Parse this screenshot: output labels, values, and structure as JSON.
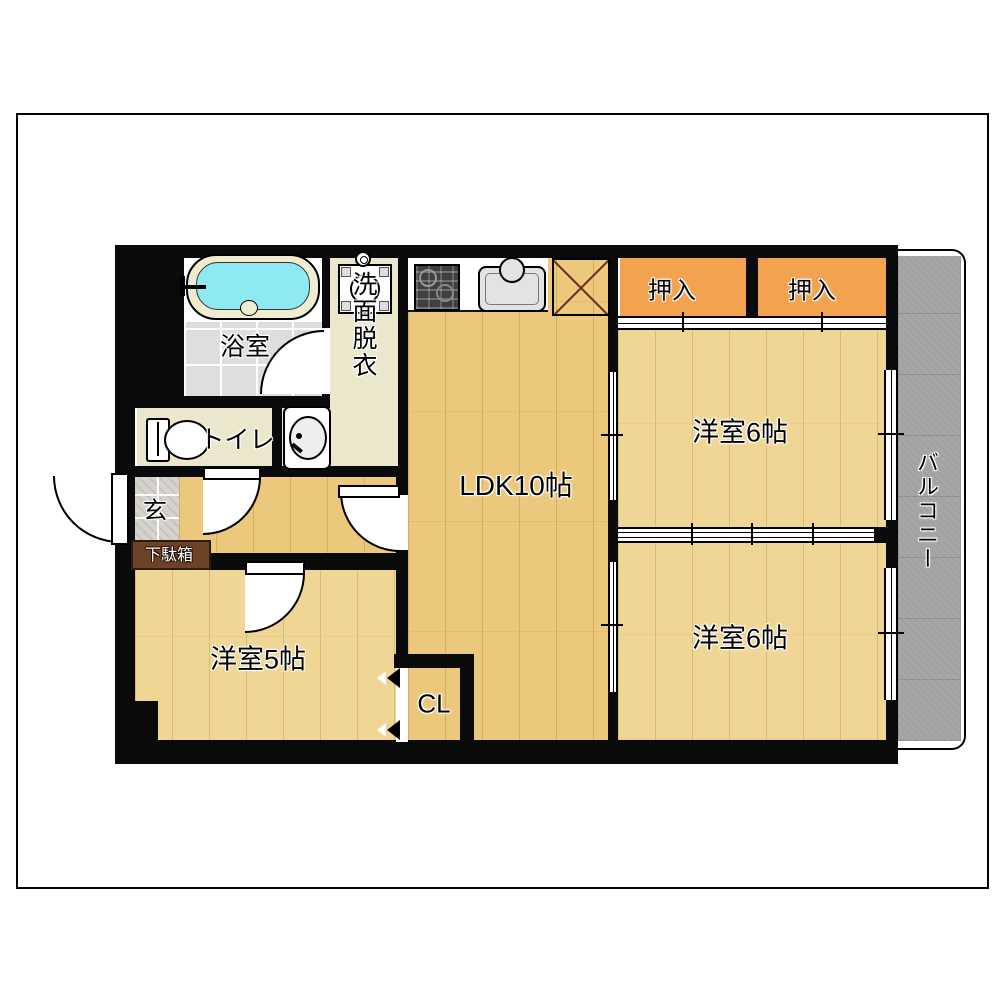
{
  "plan": {
    "labels": {
      "bathroom": "浴室",
      "washroom": "洗面脱衣",
      "toilet": "トイレ",
      "entrance": "玄",
      "shoe_cabinet": "下駄箱",
      "ldk": "LDK10帖",
      "oshiire_left": "押入",
      "oshiire_right": "押入",
      "western_room_6_top": "洋室6帖",
      "western_room_6_bottom": "洋室6帖",
      "western_room_5": "洋室5帖",
      "closet": "CL",
      "balcony": "バルコニー"
    },
    "colors": {
      "wall": "#0a0a0a",
      "wood-hall": "#ecc87c",
      "wood-room": "#f0d694",
      "closet": "#f3a24d",
      "beige": "#eae7cc",
      "bath-tile": "#dedede",
      "genkan-tile": "#d6d3cf",
      "balcony": "#a2a2a4",
      "tub-water": "#8ee9f2",
      "tub-rim": "#f0ecd0",
      "shoe-cabinet": "#6e4226",
      "fridge-x": "#6b2b18",
      "stove": "#3f3f3f",
      "sink": "#e3e3e3"
    }
  }
}
